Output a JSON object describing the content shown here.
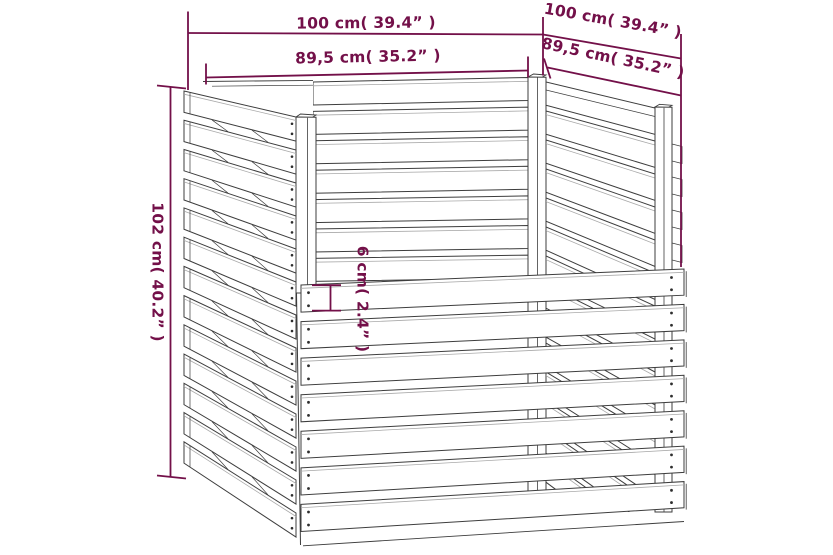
{
  "diagram": {
    "kind": "product dimension line drawing",
    "dimensions": {
      "front_width": {
        "label": "100 cm( 39.4” )"
      },
      "front_inner_width": {
        "label": "89,5 cm( 35.2” )"
      },
      "side_depth": {
        "label": "100 cm( 39.4” )"
      },
      "side_inner_depth": {
        "label": "89,5 cm( 35.2” )"
      },
      "height": {
        "label": "102 cm( 40.2” )"
      },
      "slat_height": {
        "label": "6 cm( 2.4” )"
      }
    },
    "colors": {
      "dimension": "#731049",
      "line": "#3D3D3D",
      "line_light": "#A9A9A9",
      "screw": "#2E2E2E",
      "wood_fill": "#FFFFFF",
      "background": "#FFFFFF"
    }
  }
}
